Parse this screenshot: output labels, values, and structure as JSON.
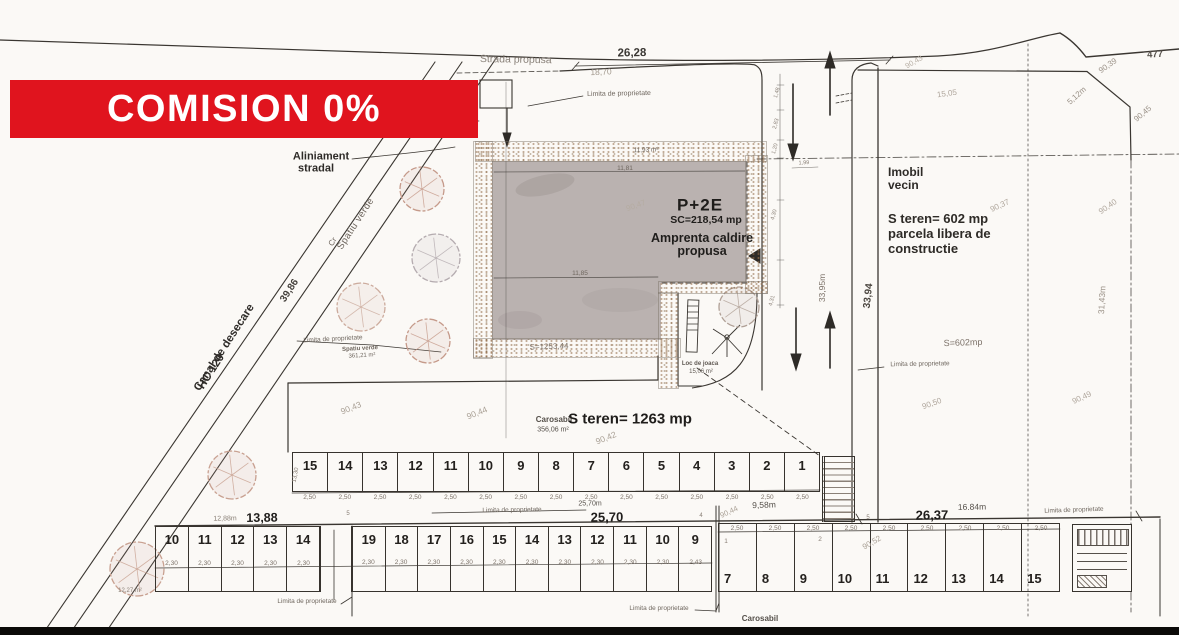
{
  "banner": {
    "text": "COMISION 0%",
    "bg": "#e0141e",
    "fg": "#ffffff"
  },
  "top": {
    "street_name": "Strada propusa",
    "dim": "26,28",
    "dim_sub": "18,70",
    "limita": "Limita de proprietate",
    "corner_dim": "477",
    "n_90_43": "90,43",
    "n_15_05": "15,05",
    "n_90_39": "90,39",
    "n_5_12": "5,12m",
    "n_90_45": "90,45"
  },
  "left": {
    "aliniament_1": "Aliniament",
    "aliniament_2": "stradal",
    "spatiu_verde": "Spatiu verde",
    "cr": "Cr",
    "dim_39_86": "39,86",
    "canal_1": "Canal de desecare",
    "canal_2": "HC 120",
    "limita": "Limita de proprietate",
    "spatiu_small": "Spatiu verde",
    "spatiu_area": "361,21 m²",
    "tree_area": "12,27 m²"
  },
  "building": {
    "title": "P+2E",
    "sc": "SC=218,54 mp",
    "caption_1": "Amprenta caldire",
    "caption_2": "propusa",
    "area_top": "11,93 m²",
    "dim_top": "11,81",
    "dim_mid": "11,85",
    "n_faint": "90,47",
    "s_label": "S=1253,44"
  },
  "playground": {
    "name": "Loc de joaca",
    "area": "15,06 m²"
  },
  "road": {
    "dim_len": "33,95m",
    "d_1_48": "1,48",
    "d_2_83": "2,83",
    "d_1_20": "1,20",
    "d_1_99": "1,99",
    "d_4_30": "4,30",
    "d_4_31": "4,31"
  },
  "right": {
    "imobil_1": "Imobil",
    "imobil_2": "vecin",
    "steren_1": "S teren= 602 mp",
    "steren_2": "parcela libera de",
    "steren_3": "constructie",
    "s_small": "S=602mp",
    "dim_33_94": "33,94",
    "dim_31_43": "31,43m",
    "limita": "Limita de proprietate",
    "n_90_37": "90,37",
    "n_90_40": "90,40",
    "n_90_50": "90,50",
    "n_90_49": "90,49"
  },
  "mid": {
    "steren": "S teren= 1263 mp",
    "carosabil": "Carosabil",
    "carosabil_area": "356,06 m²",
    "n_90_43": "90,43",
    "n_90_44": "90,44",
    "n_90_42": "90,42"
  },
  "bottom": {
    "dim_13_88": "13,88",
    "dim_12_88": "12,88m",
    "dim_25_70": "25,70",
    "dim_25_70m": "25,70m",
    "dim_26_37": "26,37",
    "dim_16_84": "16.84m",
    "dim_9_58": "9,58m",
    "n_90_44": "90,44",
    "n_90_52": "90,52",
    "t_13_30": "13,30",
    "t_4": "4",
    "t_5": "5",
    "t_5b": "5",
    "t_1": "1",
    "t_2": "2",
    "limita_mid": "Limita de proprietate",
    "limita_bl": "Limita de proprietate",
    "limita_bc": "Limita de proprietate",
    "limita_br": "Limita de proprietate",
    "carosabil": "Carosabil"
  },
  "parcels": {
    "row_top": {
      "numbers": [
        "15",
        "14",
        "13",
        "12",
        "11",
        "10",
        "9",
        "8",
        "7",
        "6",
        "5",
        "4",
        "3",
        "2",
        "1"
      ],
      "dims": [
        "2,50",
        "2,50",
        "2,50",
        "2,50",
        "2,50",
        "2,50",
        "2,50",
        "2,50",
        "2,50",
        "2,50",
        "2,50",
        "2,50",
        "2,50",
        "2,50",
        "2,50"
      ]
    },
    "row_a": {
      "numbers": [
        "10",
        "11",
        "12",
        "13",
        "14"
      ],
      "dims": [
        "2,30",
        "2,30",
        "2,30",
        "2,30",
        "2,30"
      ]
    },
    "row_b": {
      "numbers": [
        "19",
        "18",
        "17",
        "16",
        "15",
        "14",
        "13",
        "12",
        "11",
        "10",
        "9"
      ],
      "dims": [
        "2,30",
        "2,30",
        "2,30",
        "2,30",
        "2,30",
        "2,30",
        "2,30",
        "2,30",
        "2,30",
        "2,30",
        "2,43"
      ]
    },
    "row_right": {
      "numbers": [
        "7",
        "8",
        "9",
        "10",
        "11",
        "12",
        "13",
        "14",
        "15"
      ],
      "dims": [
        "2,50",
        "2,50",
        "2,50",
        "2,50",
        "2,50",
        "2,50",
        "2,50",
        "2,50",
        "2,50"
      ]
    }
  }
}
